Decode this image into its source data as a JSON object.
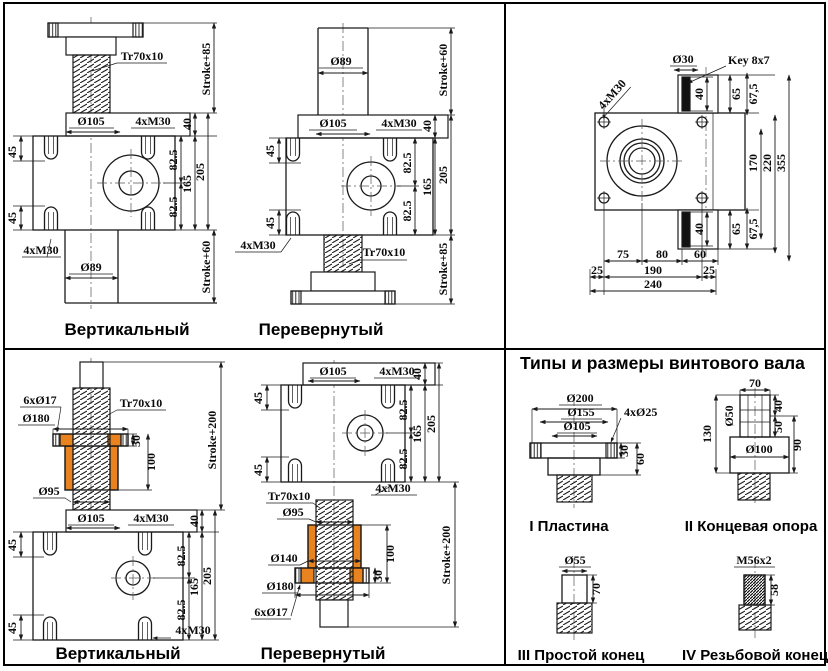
{
  "panels": {
    "jacks_standard": {
      "caption_left": "Вертикальный",
      "caption_right": "Перевернутый"
    },
    "jacks_protected": {
      "caption_left": "Вертикальный",
      "caption_right": "Перевернутый"
    },
    "shaft_ends": {
      "title": "Типы и размеры винтового вала",
      "type_labels": {
        "plate": "I Пластина",
        "end_support": "II Концевая опора",
        "plain_end": "III Простой конец",
        "threaded_end": "IV Резьбовой конец"
      }
    }
  },
  "dims": {
    "tr70x10": "Tr70x10",
    "stroke85": "Stroke+85",
    "stroke60": "Stroke+60",
    "stroke200": "Stroke+200",
    "d105": "Ø105",
    "d89": "Ø89",
    "m30x4": "4xM30",
    "n40": "40",
    "n45": "45",
    "n82_5": "82.5",
    "n165": "165",
    "n205": "205",
    "d30": "Ø30",
    "key8x7": "Key 8x7",
    "n65": "65",
    "n67_5": "67,5",
    "n170": "170",
    "n220": "220",
    "n355": "355",
    "n75": "75",
    "n80": "80",
    "n60": "60",
    "n25": "25",
    "n190": "190",
    "n240": "240",
    "d17x6": "6xØ17",
    "d180": "Ø180",
    "d140": "Ø140",
    "d95": "Ø95",
    "n30": "30",
    "n100": "100",
    "d200": "Ø200",
    "d155": "Ø155",
    "d25x4": "4xØ25",
    "n70": "70",
    "d50": "Ø50",
    "n130": "130",
    "n50": "50",
    "d100": "Ø100",
    "n90": "90",
    "d55": "Ø55",
    "m56x2": "M56x2",
    "n58": "58"
  },
  "colors": {
    "safety_nut": "#E8831F",
    "key": "#111111"
  }
}
